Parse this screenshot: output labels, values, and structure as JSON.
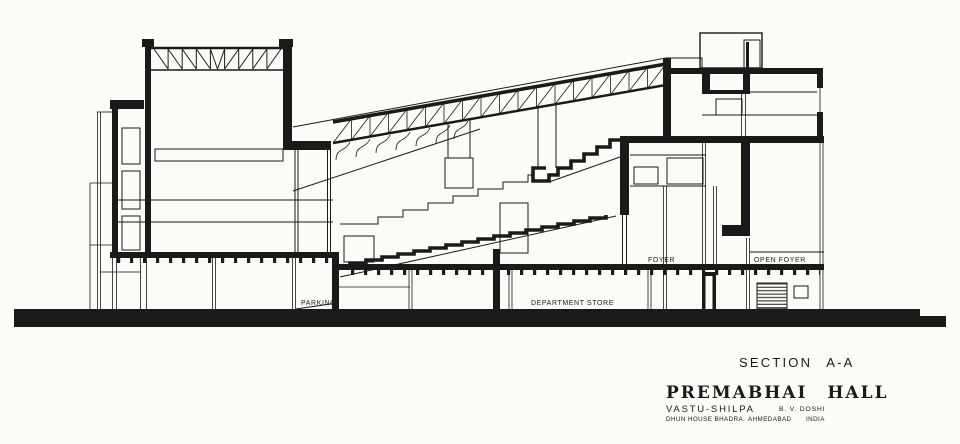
{
  "canvas": {
    "ink_color": "#1a1a1a",
    "paper_color": "#fbfbf8",
    "description": "Architectural cross section drawing"
  },
  "drawing": {
    "room_labels": {
      "parking": "PARKING",
      "department_store": "DEPARTMENT  STORE",
      "foyer": "FOYER",
      "open_foyer": "OPEN  FOYER"
    }
  },
  "title_block": {
    "section_label": "SECTION A-A",
    "project_title": "PREMABHAI HALL",
    "firm": "VASTU-SHILPA",
    "architect": "B. V. DOSHI",
    "address_line": "DHUN HOUSE BHADRA.",
    "city": "AHMEDABAD",
    "country": "INDIA"
  }
}
